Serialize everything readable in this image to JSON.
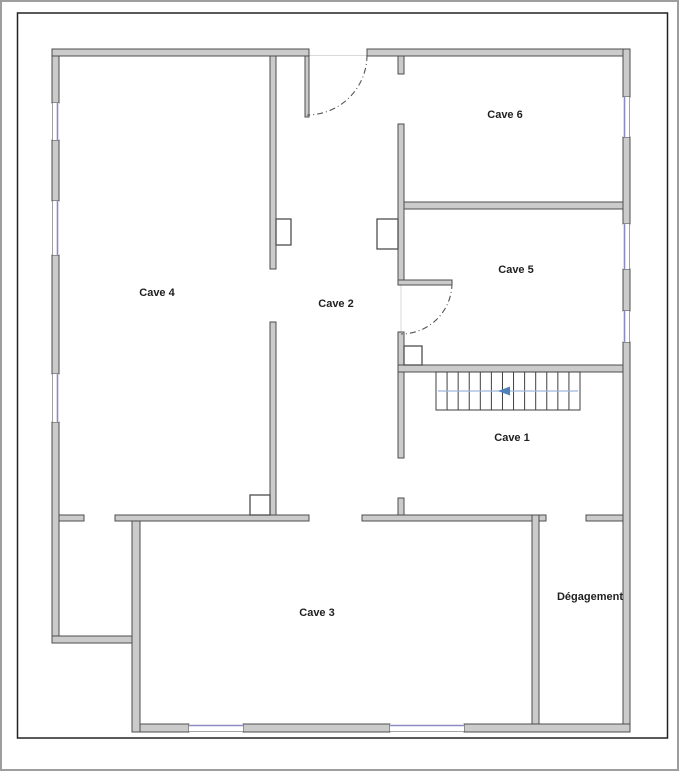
{
  "rooms": [
    {
      "id": "cave-4",
      "label": "Cave 4",
      "cx": 155,
      "cy": 291
    },
    {
      "id": "cave-2",
      "label": "Cave 2",
      "cx": 334,
      "cy": 302
    },
    {
      "id": "cave-6",
      "label": "Cave 6",
      "cx": 503,
      "cy": 113
    },
    {
      "id": "cave-5",
      "label": "Cave 5",
      "cx": 514,
      "cy": 268
    },
    {
      "id": "cave-1",
      "label": "Cave 1",
      "cx": 510,
      "cy": 436
    },
    {
      "id": "cave-3",
      "label": "Cave 3",
      "cx": 315,
      "cy": 611
    },
    {
      "id": "degagement",
      "label": "Dégagement",
      "cx": 588,
      "cy": 595
    }
  ],
  "plan": {
    "colors": {
      "background": "#ffffff",
      "outer_border": "#9e9e9e",
      "frame_stroke": "#222222",
      "wall_fill": "#cbcbcb",
      "wall_stroke": "#4d4d4d",
      "pillar_fill": "#ffffff",
      "window_blue": "#8b8bc4",
      "window_edge": "#8a8a8a",
      "threshold_gray": "#d9d9d9",
      "door_arc": "#555555",
      "stair_stroke": "#3f3f3f",
      "stair_line_blue": "#9db8d9",
      "stair_arrow_blue": "#4f81bd",
      "label_color": "#1f1f1f"
    },
    "frame": {
      "x": 15.5,
      "y": 11,
      "w": 650,
      "h": 725
    },
    "walls": [
      {
        "x": 50,
        "y": 47,
        "w": 7,
        "h": 54
      },
      {
        "x": 50,
        "y": 138,
        "w": 7,
        "h": 61
      },
      {
        "x": 50,
        "y": 253,
        "w": 7,
        "h": 119
      },
      {
        "x": 50,
        "y": 420,
        "w": 7,
        "h": 221
      },
      {
        "x": 50,
        "y": 47,
        "w": 257,
        "h": 7
      },
      {
        "x": 365,
        "y": 47,
        "w": 263,
        "h": 7
      },
      {
        "x": 621,
        "y": 47,
        "w": 7,
        "h": 48
      },
      {
        "x": 621,
        "y": 135,
        "w": 7,
        "h": 87
      },
      {
        "x": 621,
        "y": 267,
        "w": 7,
        "h": 42
      },
      {
        "x": 621,
        "y": 340,
        "w": 7,
        "h": 390
      },
      {
        "x": 130,
        "y": 722,
        "w": 57,
        "h": 8
      },
      {
        "x": 241,
        "y": 722,
        "w": 147,
        "h": 8
      },
      {
        "x": 462,
        "y": 722,
        "w": 166,
        "h": 8
      },
      {
        "x": 50,
        "y": 634,
        "w": 88,
        "h": 7
      },
      {
        "x": 130,
        "y": 513,
        "w": 8,
        "h": 217
      },
      {
        "x": 268,
        "y": 54,
        "w": 6,
        "h": 213
      },
      {
        "x": 268,
        "y": 320,
        "w": 6,
        "h": 193
      },
      {
        "x": 303,
        "y": 54,
        "w": 4,
        "h": 61
      },
      {
        "x": 396,
        "y": 54,
        "w": 6,
        "h": 18
      },
      {
        "x": 396,
        "y": 122,
        "w": 6,
        "h": 156
      },
      {
        "x": 396,
        "y": 278,
        "w": 54,
        "h": 5
      },
      {
        "x": 396,
        "y": 330,
        "w": 6,
        "h": 126
      },
      {
        "x": 396,
        "y": 496,
        "w": 6,
        "h": 22
      },
      {
        "x": 402,
        "y": 200,
        "w": 219,
        "h": 7
      },
      {
        "x": 396,
        "y": 363,
        "w": 225,
        "h": 7
      },
      {
        "x": 57,
        "y": 513,
        "w": 25,
        "h": 6
      },
      {
        "x": 113,
        "y": 513,
        "w": 194,
        "h": 6
      },
      {
        "x": 360,
        "y": 513,
        "w": 184,
        "h": 6
      },
      {
        "x": 584,
        "y": 513,
        "w": 37,
        "h": 6
      },
      {
        "x": 530,
        "y": 513,
        "w": 7,
        "h": 209
      }
    ],
    "pillars": [
      {
        "x": 274,
        "y": 217,
        "w": 15,
        "h": 26
      },
      {
        "x": 248,
        "y": 493,
        "w": 20,
        "h": 20
      },
      {
        "x": 375,
        "y": 217,
        "w": 21,
        "h": 30
      },
      {
        "x": 402,
        "y": 344,
        "w": 18,
        "h": 19
      }
    ],
    "windows": [
      {
        "x": 50,
        "y": 101,
        "w": 7,
        "h": 37,
        "face": "right"
      },
      {
        "x": 50,
        "y": 199,
        "w": 7,
        "h": 54,
        "face": "right"
      },
      {
        "x": 50,
        "y": 372,
        "w": 7,
        "h": 48,
        "face": "right"
      },
      {
        "x": 621,
        "y": 95,
        "w": 7,
        "h": 40,
        "face": "left"
      },
      {
        "x": 621,
        "y": 222,
        "w": 7,
        "h": 45,
        "face": "left"
      },
      {
        "x": 621,
        "y": 309,
        "w": 7,
        "h": 31,
        "face": "left"
      },
      {
        "x": 187,
        "y": 722,
        "w": 54,
        "h": 8,
        "face": "top"
      },
      {
        "x": 388,
        "y": 722,
        "w": 74,
        "h": 8,
        "face": "top"
      }
    ],
    "thresholds": [
      {
        "x1": 307,
        "y1": 53.5,
        "x2": 365,
        "y2": 53.5
      },
      {
        "x1": 399,
        "y1": 283,
        "x2": 399,
        "y2": 330
      }
    ],
    "doors": [
      {
        "path": "M 365,53 A 60,60 0 0 1 305,113"
      },
      {
        "path": "M 450,281 A 51,51 0 0 1 399,332"
      }
    ],
    "stairs": {
      "x": 434,
      "y": 370,
      "w": 144,
      "h": 38,
      "steps": 13,
      "line": {
        "x1": 436,
        "y1": 389,
        "x2": 576,
        "y2": 389
      },
      "arrow": {
        "tip_x": 496,
        "back_x": 508,
        "cy": 389,
        "half_h": 4.5
      }
    }
  }
}
